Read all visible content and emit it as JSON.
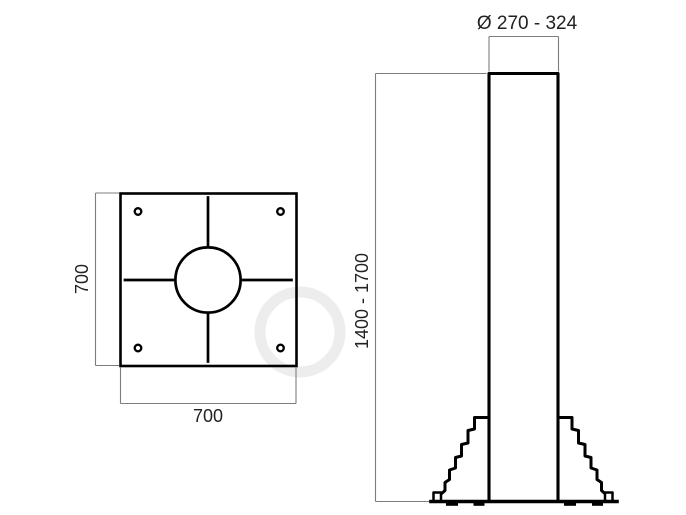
{
  "drawing": {
    "description": "Technical drawing of a pole base: top view of square anchor plate and side elevation of pole with stepped cast base",
    "top_view": {
      "plate_width_label": "700",
      "plate_height_label": "700"
    },
    "side_view": {
      "diameter_label": "Ø 270 - 324",
      "height_label": "1400 - 1700"
    },
    "colors": {
      "outline": "#000000",
      "dimension_line": "#7d7d7d",
      "text": "#222222",
      "background": "#ffffff",
      "watermark": "#ededed"
    }
  }
}
